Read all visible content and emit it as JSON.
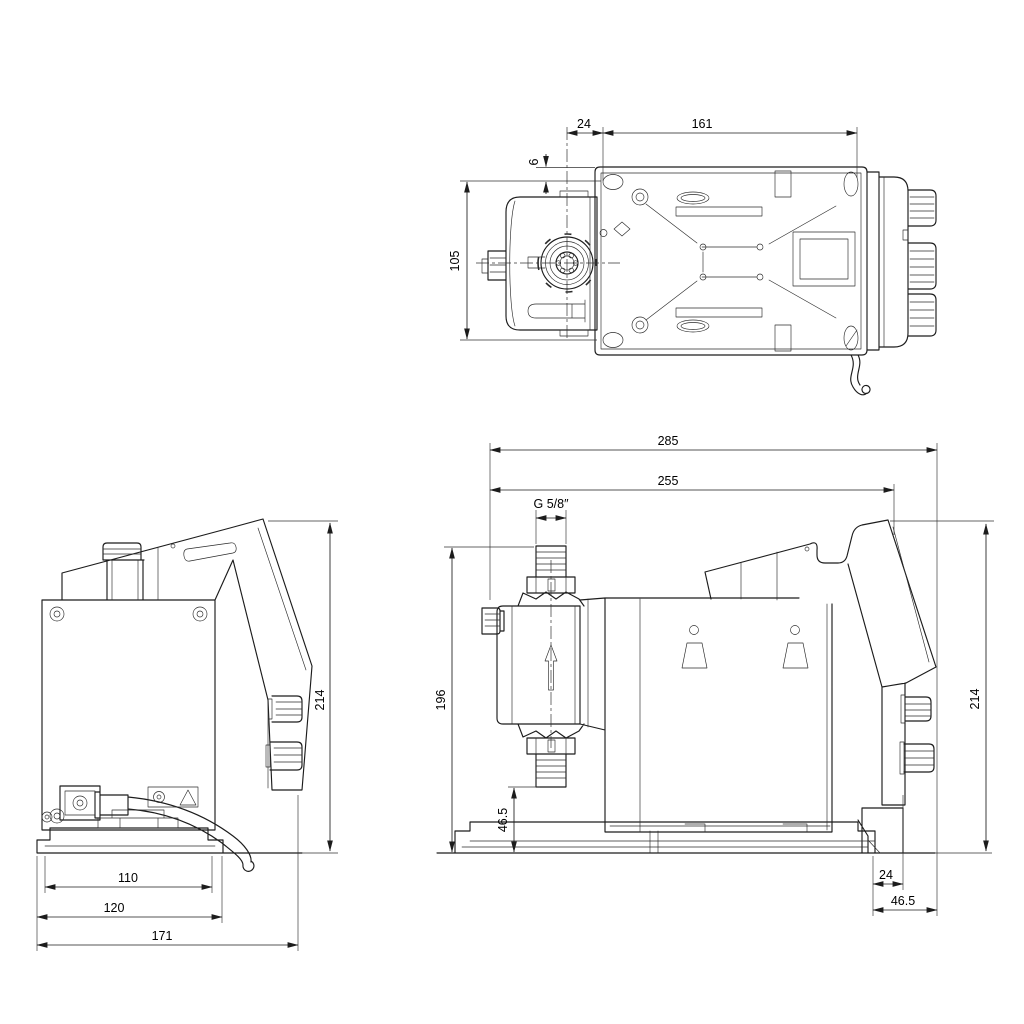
{
  "drawing": {
    "background": "#ffffff",
    "line_color": "#1c1c1c",
    "views": {
      "top": {
        "dims": {
          "offset": "24",
          "span": "161",
          "edge": "6",
          "depth": "105"
        }
      },
      "front": {
        "dims": {
          "height": "214",
          "inner_width": "110",
          "mid_width": "120",
          "overall": "171"
        }
      },
      "side": {
        "dims": {
          "overall": "285",
          "body": "255",
          "thread": "G 5/8″",
          "height_front": "196",
          "bottom_clearance": "46.5",
          "height_rear": "214",
          "rear_offset": "24",
          "rear_depth": "46.5"
        }
      }
    }
  }
}
